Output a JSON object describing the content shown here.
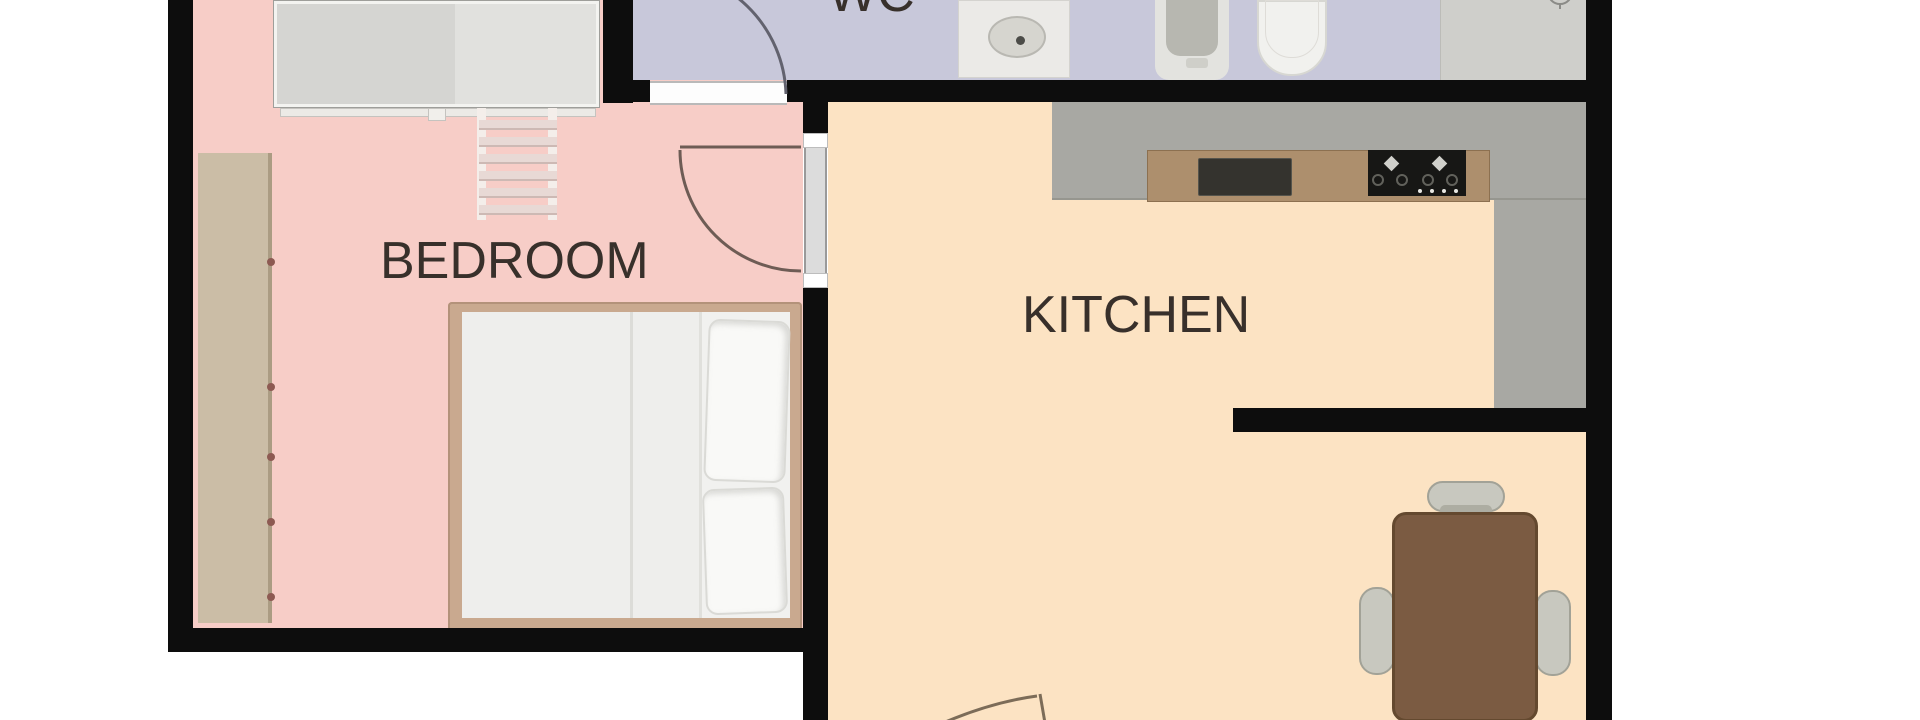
{
  "rooms": {
    "bedroom": {
      "label": "BEDROOM"
    },
    "wc": {
      "label": "WC"
    },
    "kitchen": {
      "label": "KITCHEN"
    }
  },
  "colors": {
    "outside": "#ffffff",
    "wall": "#0d0d0d",
    "bedroom_floor": "#f7cdc7",
    "wc_floor": "#c8c8da",
    "kitchen_floor": "#fce3c3",
    "label_text": "#38302b",
    "counter_gray": "#a8a8a3",
    "counter_wood": "#ad8f6d",
    "kitchen_sink": "#34332e",
    "hob_black": "#171715",
    "table_wood": "#7b5b42",
    "chair_gray": "#c8c8bf",
    "wardrobe_gray": "#d5d5d2",
    "shelf_tan": "#cbbda6",
    "bed_frame_tan": "#c9a98f",
    "mattress_white": "#f1f1ef",
    "pillow_white": "#f9f9f7",
    "fixture_white": "#ebeae7",
    "toilet_bowl_gray": "#b7b7b0",
    "shower_tray_gray": "#cfcfcb",
    "door_arc": "#6e5c55",
    "wc_door_arc": "#62626e",
    "kitchen_door_arc": "#7c6c58",
    "ladder_rung": "#e8d9d5"
  }
}
